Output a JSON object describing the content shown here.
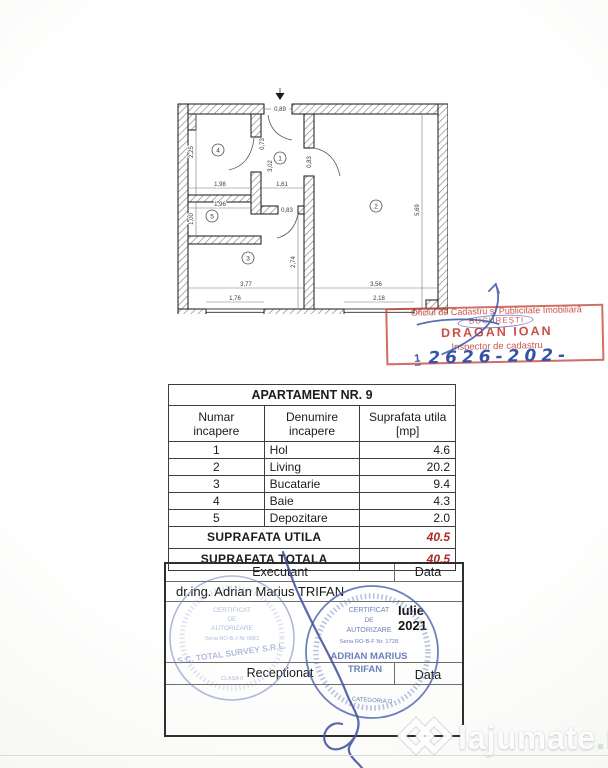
{
  "floor_plan": {
    "rooms": [
      "1",
      "2",
      "3",
      "4",
      "5"
    ],
    "dims": {
      "entrance": "0,89",
      "room4_h": "2,25",
      "room4_w": "1,98",
      "door_room4": "0,73",
      "hall_h": "3,02",
      "hall_w": "1,61",
      "door_room2": "0,83",
      "door_room3": "0,83",
      "room5_w": "1,96",
      "room5_h": "1,00",
      "room2_h": "5,69",
      "room2_w": "3,56",
      "window_room2": "2,18",
      "room3_h": "2,74",
      "room3_w": "3,77",
      "window_room3": "1,76"
    }
  },
  "office_stamp": {
    "line1": "Oficiul de Cadastru și Publicitate Imobiliară",
    "line2": "BUCUREȘTI",
    "name": "DRAGAN IOAN",
    "role": "Inspector de cadastru",
    "number_prefix": "1",
    "number": "2626-202-"
  },
  "table": {
    "title": "APARTAMENT NR. 9",
    "col_num_1": "Numar",
    "col_num_2": "incapere",
    "col_name_1": "Denumire",
    "col_name_2": "incapere",
    "col_area_1": "Suprafata utila",
    "col_area_2": "[mp]",
    "rows": [
      {
        "num": "1",
        "name": "Hol",
        "area": "4.6"
      },
      {
        "num": "2",
        "name": "Living",
        "area": "20.2"
      },
      {
        "num": "3",
        "name": "Bucatarie",
        "area": "9.4"
      },
      {
        "num": "4",
        "name": "Baie",
        "area": "4.3"
      },
      {
        "num": "5",
        "name": "Depozitare",
        "area": "2.0"
      }
    ],
    "util_label": "SUPRAFATA UTILA",
    "util_value": "40.5",
    "total_label": "SUPRAFATA TOTALA",
    "total_value": "40.5"
  },
  "signature_block": {
    "executant_label": "Executant",
    "data_label_1": "Data",
    "executant_name": "dr.ing. Adrian Marius TRIFAN",
    "date_month": "Iulie",
    "date_year": "2021",
    "receptionat_label": "Receptionat",
    "data_label_2": "Data",
    "company_stamp": {
      "l1": "CERTIFICAT",
      "l2": "DE",
      "l3": "AUTORIZARE",
      "l4": "Seria RO-B-J Nr 0883",
      "l5": "S.C. TOTAL SURVEY S.R.L.",
      "l6": "CLASA II"
    },
    "person_stamp": {
      "l1": "CERTIFICAT",
      "l2": "DE",
      "l3": "AUTORIZARE",
      "l4": "Seria RO-B-F Nr. 1728",
      "l5": "ADRIAN MARIUS",
      "l6": "TRIFAN",
      "l7": "CATEGORIA D"
    }
  },
  "watermark": {
    "text": "lajumate",
    "tld": ".ro"
  },
  "colors": {
    "stamp_red": "#bf4a3e",
    "pen_blue": "#3b55a6",
    "total_red": "#b02a25"
  }
}
